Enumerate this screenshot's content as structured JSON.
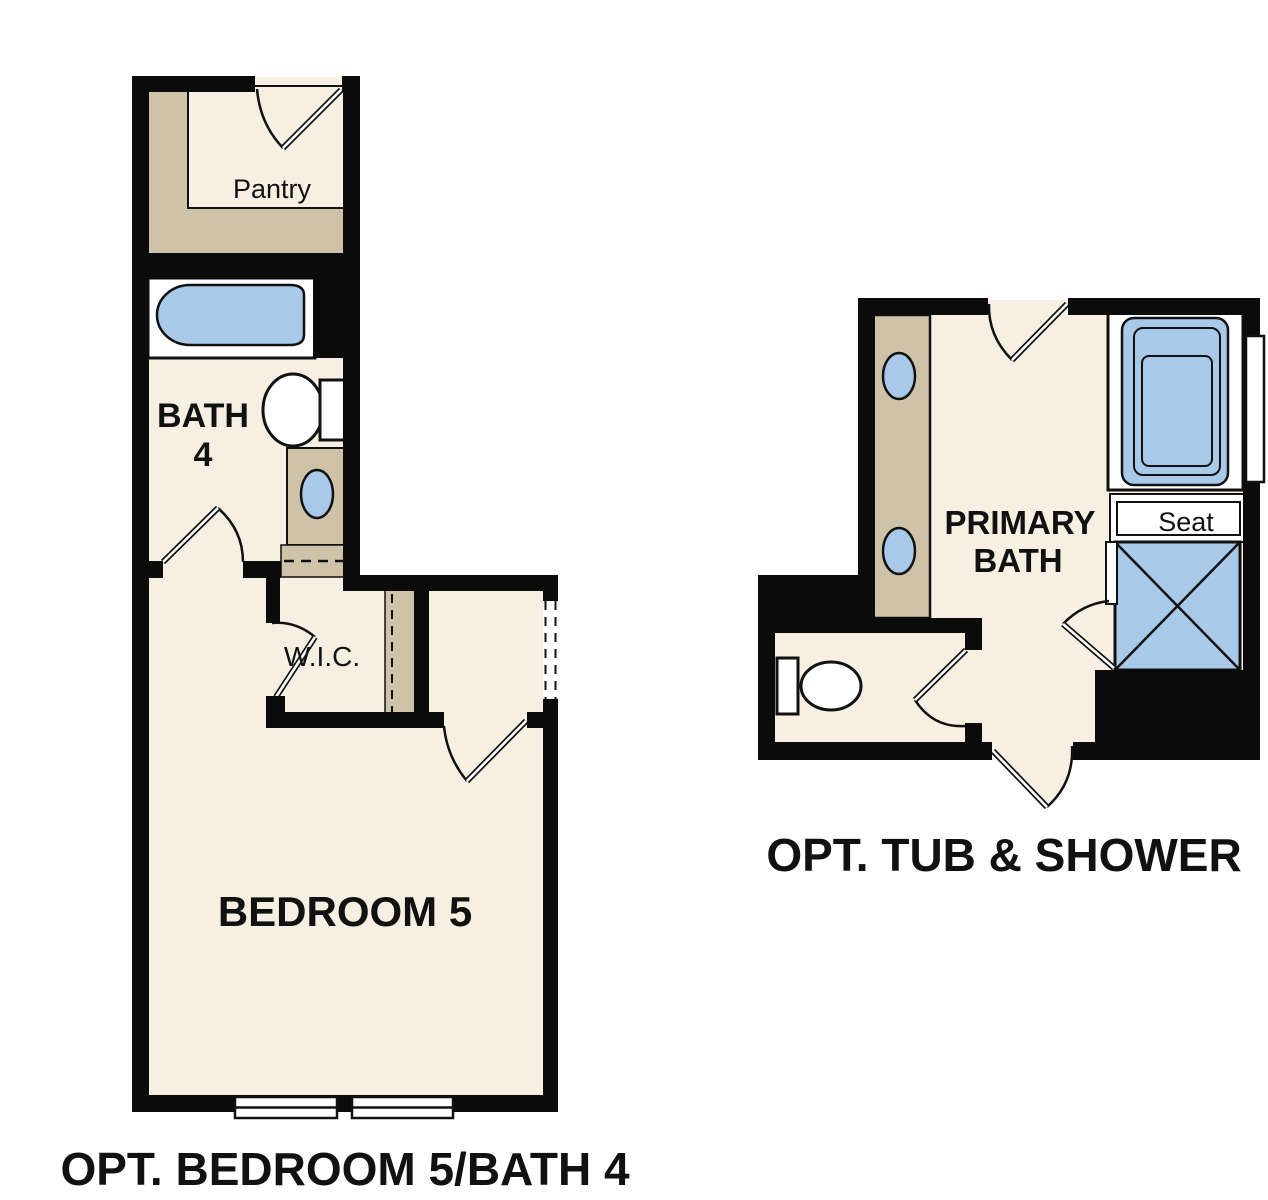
{
  "colors": {
    "background": "#ffffff",
    "wall": "#0b0b0b",
    "floor": "#f6efe2",
    "cabinet_tan": "#cec2a9",
    "fixture_blue": "#a9c9e9",
    "fixture_white": "#ffffff",
    "line": "#111111"
  },
  "plan_left": {
    "caption": "OPT. BEDROOM 5/BATH 4",
    "labels": {
      "pantry": "Pantry",
      "bath_line1": "BATH",
      "bath_line2": "4",
      "wic": "W.I.C.",
      "bedroom": "BEDROOM 5"
    }
  },
  "plan_right": {
    "caption": "OPT. TUB & SHOWER",
    "labels": {
      "primary_line1": "PRIMARY",
      "primary_line2": "BATH",
      "seat": "Seat"
    }
  }
}
